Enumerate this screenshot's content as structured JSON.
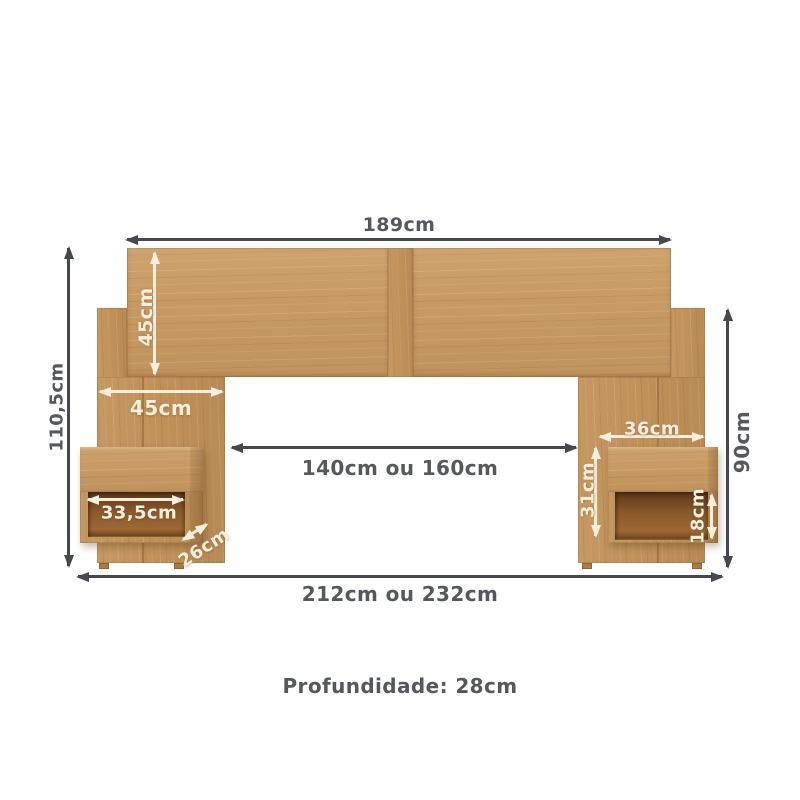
{
  "colors": {
    "wood_light": "#cda06a",
    "wood_mid": "#c1925a",
    "wood_dark": "#a87b45",
    "shelf_interior": "#7a4e23",
    "dimension_dark": "#45484c",
    "dimension_light": "#f5eedd",
    "text_dark": "#55585c"
  },
  "dimensions": {
    "headboard_width": "189cm",
    "headboard_panel_height": "45cm",
    "total_height": "110,5cm",
    "side_panel_width": "45cm",
    "left_niche_width": "33,5cm",
    "nightstand_depth": "26cm",
    "inner_span": "140cm ou 160cm",
    "right_nightstand_width": "36cm",
    "right_nightstand_height": "31cm",
    "right_niche_height": "18cm",
    "side_height": "90cm",
    "total_width": "212cm ou 232cm",
    "depth_note": "Profundidade: 28cm"
  }
}
